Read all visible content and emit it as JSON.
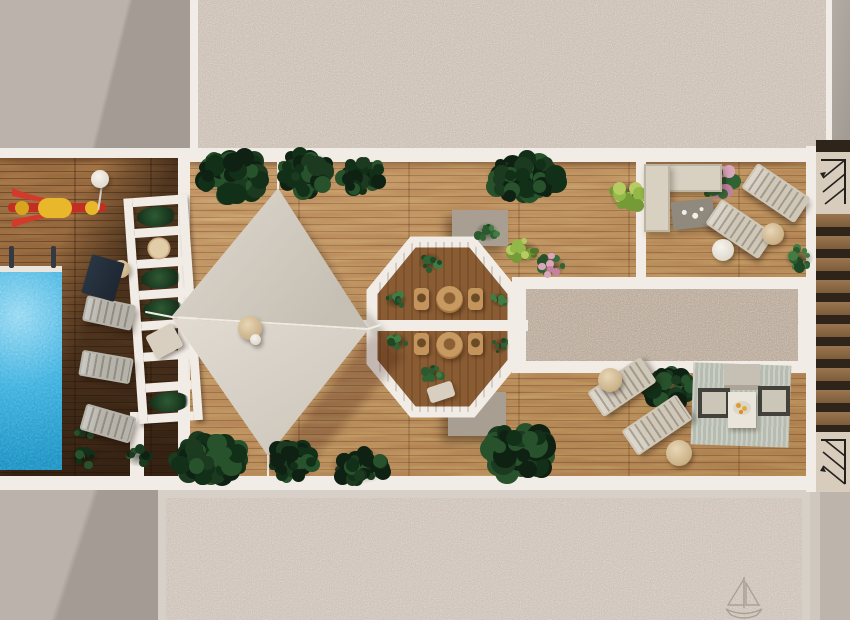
{
  "image": {
    "subject": "top-down 3D rendering of a rooftop terrace with swimming pool, shade sails, octagon pavilion and lounge areas",
    "view": "aerial plan view"
  },
  "palette": {
    "white_rail": "#f1ece5",
    "concrete_light": "#bab2ab",
    "concrete_shadow": "#a39b94",
    "gravel_top": "#c6b9ac",
    "gravel_mid": "#b2a08e",
    "gravel_bottom": "#c8bcb1",
    "wood_light": "#b5824f",
    "wood_dark": "#7c5633",
    "wood_inner": "#8a5c33",
    "pool_blue": "#3fa9dc",
    "sail_upper": "#d4cdc3",
    "sail_lower": "#ddd6cc",
    "taupe_block": "#a89e92",
    "sofa_beige": "#d8d1c2",
    "lounger_gray": "#b6b3ab",
    "lounger_beige": "#cfc7b8",
    "wicker_tan": "#c3955c",
    "table_tan": "#d8c3a3",
    "rug_green": "#b7bcb0",
    "stair_wood": "#8a6742",
    "stair_dark": "#2e2419",
    "stair_box": "#d8ccbc",
    "accent_red": "#d23a2c",
    "accent_yellow": "#e8b82a"
  },
  "scene": {
    "plant_tones": {
      "dark": [
        "#0e2113",
        "#1b3a20",
        "#27522c",
        "#123018"
      ],
      "medium": [
        "#1f4725",
        "#2f6333",
        "#417d42",
        "#2a5a2e"
      ],
      "bright": [
        "#55732a",
        "#759b36",
        "#93b748",
        "#b6cc62"
      ],
      "pink": [
        "#27522c",
        "#3a6b3c",
        "#c282a0",
        "#daa6bc",
        "#2f6333"
      ]
    },
    "plants": [
      {
        "x": 232,
        "y": 176,
        "rx": 40,
        "ry": 26,
        "tone": "dark"
      },
      {
        "x": 306,
        "y": 172,
        "rx": 32,
        "ry": 24,
        "tone": "dark"
      },
      {
        "x": 362,
        "y": 176,
        "rx": 26,
        "ry": 20,
        "tone": "dark"
      },
      {
        "x": 524,
        "y": 178,
        "rx": 42,
        "ry": 26,
        "tone": "dark"
      },
      {
        "x": 487,
        "y": 232,
        "rx": 13,
        "ry": 11,
        "tone": "medium"
      },
      {
        "x": 628,
        "y": 196,
        "rx": 20,
        "ry": 16,
        "tone": "bright"
      },
      {
        "x": 524,
        "y": 252,
        "rx": 18,
        "ry": 14,
        "tone": "bright"
      },
      {
        "x": 552,
        "y": 266,
        "rx": 16,
        "ry": 13,
        "tone": "pink"
      },
      {
        "x": 210,
        "y": 458,
        "rx": 44,
        "ry": 26,
        "tone": "dark"
      },
      {
        "x": 292,
        "y": 462,
        "rx": 30,
        "ry": 22,
        "tone": "dark"
      },
      {
        "x": 360,
        "y": 466,
        "rx": 32,
        "ry": 20,
        "tone": "dark"
      },
      {
        "x": 520,
        "y": 452,
        "rx": 38,
        "ry": 30,
        "tone": "dark"
      },
      {
        "x": 84,
        "y": 458,
        "rx": 16,
        "ry": 12,
        "tone": "dark"
      },
      {
        "x": 138,
        "y": 456,
        "rx": 15,
        "ry": 12,
        "tone": "dark"
      },
      {
        "x": 85,
        "y": 432,
        "rx": 11,
        "ry": 9,
        "tone": "dark"
      },
      {
        "x": 718,
        "y": 182,
        "rx": 22,
        "ry": 18,
        "tone": "pink"
      },
      {
        "x": 799,
        "y": 258,
        "rx": 16,
        "ry": 13,
        "tone": "medium"
      },
      {
        "x": 668,
        "y": 388,
        "rx": 30,
        "ry": 22,
        "tone": "dark"
      },
      {
        "x": 712,
        "y": 380,
        "rx": 17,
        "ry": 15,
        "tone": "medium"
      },
      {
        "x": 768,
        "y": 378,
        "rx": 16,
        "ry": 14,
        "tone": "medium"
      },
      {
        "x": 430,
        "y": 262,
        "rx": 13,
        "ry": 11,
        "tone": "medium"
      },
      {
        "x": 396,
        "y": 300,
        "rx": 12,
        "ry": 10,
        "tone": "medium"
      },
      {
        "x": 398,
        "y": 342,
        "rx": 11,
        "ry": 10,
        "tone": "medium"
      },
      {
        "x": 432,
        "y": 374,
        "rx": 12,
        "ry": 10,
        "tone": "medium"
      },
      {
        "x": 500,
        "y": 300,
        "rx": 10,
        "ry": 9,
        "tone": "medium"
      },
      {
        "x": 500,
        "y": 346,
        "rx": 10,
        "ry": 9,
        "tone": "medium"
      }
    ],
    "loungers": [
      {
        "x": 84,
        "y": 300,
        "w": 50,
        "h": 26,
        "rot": 12,
        "color": "lounger_gray"
      },
      {
        "x": 80,
        "y": 354,
        "w": 52,
        "h": 26,
        "rot": 10,
        "color": "lounger_gray"
      },
      {
        "x": 82,
        "y": 410,
        "w": 52,
        "h": 27,
        "rot": 16,
        "color": "lounger_gray"
      },
      {
        "x": 744,
        "y": 178,
        "w": 64,
        "h": 30,
        "rot": 34,
        "color": "lounger_beige"
      },
      {
        "x": 708,
        "y": 214,
        "w": 64,
        "h": 30,
        "rot": 34,
        "color": "lounger_beige"
      },
      {
        "x": 590,
        "y": 372,
        "w": 64,
        "h": 30,
        "rot": -34,
        "color": "lounger_beige"
      },
      {
        "x": 624,
        "y": 410,
        "w": 66,
        "h": 30,
        "rot": -34,
        "color": "lounger_beige"
      }
    ],
    "tables": [
      {
        "x": 112,
        "y": 260,
        "d": 18,
        "kind": "tan"
      },
      {
        "x": 238,
        "y": 316,
        "d": 24,
        "kind": "tan"
      },
      {
        "x": 250,
        "y": 334,
        "d": 11,
        "kind": "white"
      },
      {
        "x": 436,
        "y": 286,
        "d": 27,
        "kind": "wood"
      },
      {
        "x": 436,
        "y": 332,
        "d": 27,
        "kind": "wood"
      },
      {
        "x": 762,
        "y": 223,
        "d": 22,
        "kind": "tan"
      },
      {
        "x": 712,
        "y": 239,
        "d": 22,
        "kind": "white"
      },
      {
        "x": 666,
        "y": 440,
        "d": 26,
        "kind": "tan"
      },
      {
        "x": 598,
        "y": 368,
        "d": 24,
        "kind": "tan"
      },
      {
        "x": 91,
        "y": 170,
        "d": 18,
        "kind": "white"
      }
    ],
    "chairs": [
      {
        "x": 414,
        "y": 288,
        "w": 15,
        "h": 22,
        "rot": 0,
        "kind": "wicker"
      },
      {
        "x": 468,
        "y": 288,
        "w": 15,
        "h": 22,
        "rot": 0,
        "kind": "wicker"
      },
      {
        "x": 414,
        "y": 333,
        "w": 15,
        "h": 22,
        "rot": 0,
        "kind": "wicker"
      },
      {
        "x": 468,
        "y": 333,
        "w": 15,
        "h": 22,
        "rot": 0,
        "kind": "wicker"
      },
      {
        "x": 428,
        "y": 384,
        "w": 26,
        "h": 16,
        "rot": -18,
        "kind": "beige-chair"
      },
      {
        "x": 86,
        "y": 258,
        "w": 34,
        "h": 40,
        "rot": 16,
        "kind": "mat"
      }
    ],
    "stairs": {
      "steps_from": 74,
      "step_count": 10,
      "step_pitch": 22
    }
  }
}
